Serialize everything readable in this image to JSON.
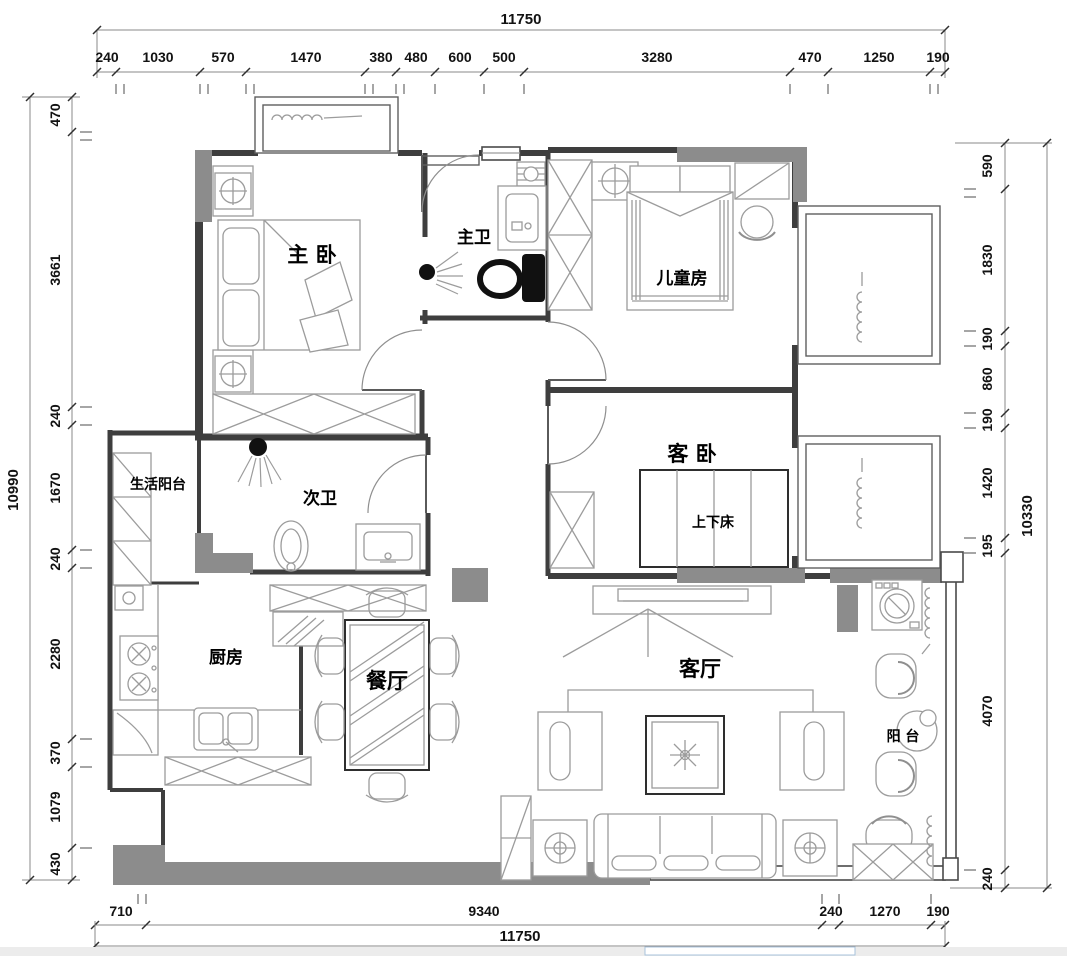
{
  "plan": {
    "rooms": {
      "master_bedroom": "主 卧",
      "master_bath": "主卫",
      "kids_room": "儿童房",
      "guest_bedroom": "客 卧",
      "bunk_bed": "上下床",
      "second_bath": "次卫",
      "service_balcony": "生活阳台",
      "kitchen": "厨房",
      "dining": "餐厅",
      "living": "客厅",
      "balcony": "阳 台"
    },
    "dims": {
      "top": {
        "total": "11750",
        "segs": [
          "240",
          "1030",
          "570",
          "1470",
          "380",
          "480",
          "600",
          "500",
          "3280",
          "470",
          "1250",
          "190"
        ]
      },
      "left": {
        "total": "10990",
        "segs": [
          "470",
          "3661",
          "240",
          "1670",
          "240",
          "2280",
          "370",
          "1079",
          "430"
        ]
      },
      "right": {
        "total": "10330",
        "segs": [
          "590",
          "1830",
          "190",
          "860",
          "190",
          "1420",
          "195",
          "4070",
          "240"
        ]
      },
      "bottom": {
        "total": "11750",
        "segs": [
          "710",
          "9340",
          "240",
          "1270",
          "190"
        ]
      }
    },
    "colors": {
      "wall_fill": "#8c8c8c",
      "line": "#3e3e3e",
      "fixture": "#111111",
      "furniture": "#9c9c9c"
    }
  }
}
